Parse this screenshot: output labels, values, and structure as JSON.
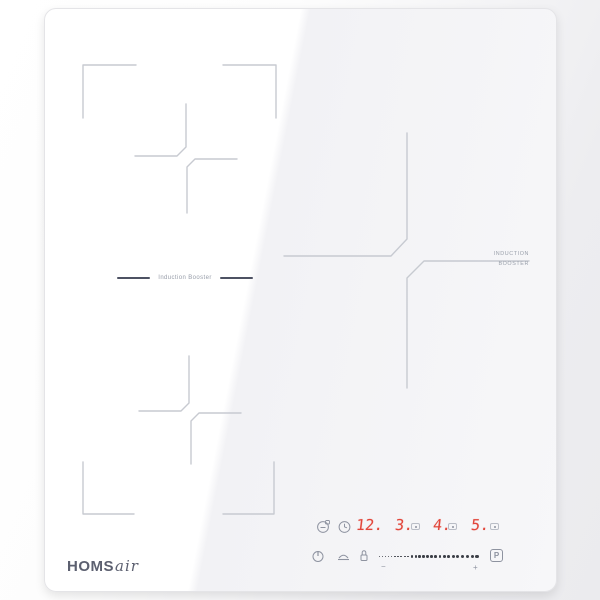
{
  "product": {
    "brand_bold": "HOMS",
    "brand_script": "air"
  },
  "labels": {
    "left_zone_booster": "Induction Booster",
    "right_zone_booster_line1": "INDUCTION",
    "right_zone_booster_line2": "BOOSTER"
  },
  "control_panel": {
    "display_timer": "12.",
    "display_zone1": "3.",
    "display_zone2": "4.",
    "display_zone3": "5.",
    "booster_button_label": "P",
    "slider_minus": "−",
    "slider_plus": "+",
    "slider_dot_count": 26
  },
  "icons": {
    "top_row": [
      "pan-detect-icon",
      "timer-icon"
    ],
    "indicator_row": [
      "zone-indicator",
      "zone-indicator",
      "zone-indicator"
    ],
    "bottom_row": [
      "power-icon",
      "keep-warm-icon",
      "lock-icon"
    ]
  },
  "colors": {
    "display_red": "#e2453a",
    "zone_line_grey": "#c7cad1",
    "panel_icon_grey": "#8e93a0",
    "label_dash_dark": "#4d5263",
    "logo_grey": "#5c6070"
  }
}
